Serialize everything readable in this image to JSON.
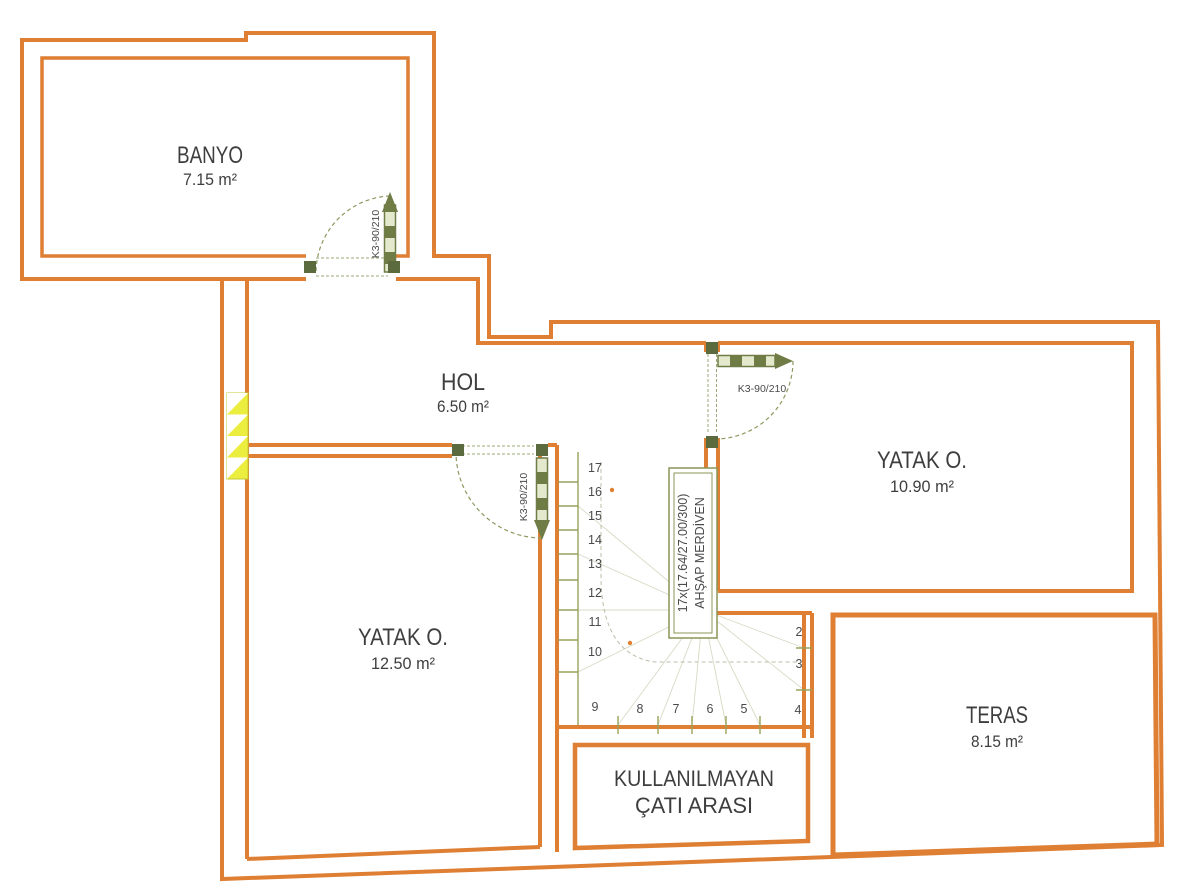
{
  "plan_title": "Çatı katı plan (attic floor plan)",
  "rooms": {
    "banyo": {
      "name": "BANYO",
      "area": "7.15 m²"
    },
    "hol": {
      "name": "HOL",
      "area": "6.50 m²"
    },
    "yatak_right": {
      "name": "YATAK O.",
      "area": "10.90 m²"
    },
    "yatak_left": {
      "name": "YATAK O.",
      "area": "12.50 m²"
    },
    "teras": {
      "name": "TERAS",
      "area": "8.15 m²"
    },
    "attic": {
      "line1": "KULLANILMAYAN",
      "line2": "ÇATI ARASI"
    }
  },
  "doors": {
    "banyo_label": "K3-90/210",
    "yatak_left_label": "K3-90/210",
    "yatak_right_label": "K3-90/210"
  },
  "stairs": {
    "label_line1": "17x(17.64/27.00/300)",
    "label_line2": "AHŞAP MERDİVEN",
    "left_numbers": [
      "17",
      "16",
      "15",
      "14",
      "13",
      "12",
      "11",
      "10"
    ],
    "bottom_numbers": [
      "9",
      "8",
      "7",
      "6",
      "5",
      "4"
    ],
    "right_numbers": [
      "2",
      "3"
    ]
  },
  "colors": {
    "wall_orange": "#DE7F33",
    "door_olive": "#6F7C45",
    "door_fill": "#E4E9CE",
    "post_dark": "#5C6B3D",
    "hatch_yellow": "#ECEE3F",
    "stair_line": "#97A25B",
    "text_gray": "#3E3E3E"
  }
}
